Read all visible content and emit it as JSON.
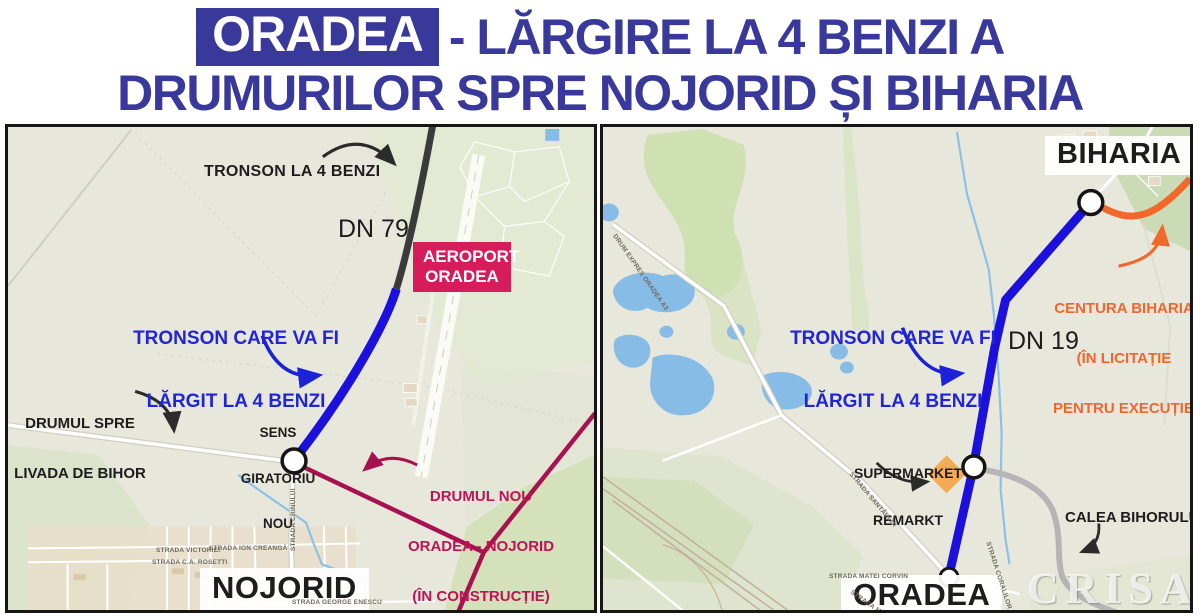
{
  "title": {
    "highlight": "ORADEA",
    "rest": "- LĂRGIRE LA 4 BENZI A",
    "line2": "DRUMURILOR SPRE NOJORID ȘI BIHARIA"
  },
  "colors": {
    "title_blue": "#39399B",
    "route_blue": "#1B10DC",
    "route_crimson": "#A8114F",
    "route_orange": "#F2682A",
    "route_gray": "#B5B5B5",
    "airport_badge_pink": "#D61C5B",
    "map_background": "#E8E7DC"
  },
  "left_map": {
    "annotations": {
      "four_lane": "TRONSON LA 4 BENZI",
      "dn79": "DN 79",
      "airport": [
        "AEROPORT",
        "ORADEA"
      ],
      "widen": [
        "TRONSON CARE VA FI",
        "LĂRGIT LA 4 BENZI"
      ],
      "livada": [
        "DRUMUL SPRE",
        "LIVADA DE BIHOR"
      ],
      "roundabout": [
        "SENS",
        "GIRATORIU",
        "NOU"
      ],
      "new_road": [
        "DRUMUL NOU",
        "ORADEA - NOJORID",
        "(ÎN CONSTRUCȚIE)"
      ],
      "town": "NOJORID"
    },
    "streets": {
      "victoriei": "STRADA VICTORIEI",
      "creanga": "STRADA ION CREANGĂ",
      "rosetti": "STRADA C.A. ROSETTI",
      "enescu": "STRADA GEORGE ENESCU",
      "crinului": "STRADA CRINULUI"
    }
  },
  "right_map": {
    "annotations": {
      "town_top": "BIHARIA",
      "widen": [
        "TRONSON CARE VA FI",
        "LĂRGIT LA 4 BENZI"
      ],
      "dn19": "DN 19",
      "centura": [
        "CENTURA BIHARIA",
        "(ÎN LICITAȚIE",
        "PENTRU EXECUȚIE)"
      ],
      "supermarket": [
        "SUPERMARKET",
        "REMARKT"
      ],
      "calea": "CALEA BIHORULUI",
      "town_bottom": "ORADEA",
      "watermark": "CRISANA"
    },
    "streets": {
      "expres": "DRUM EXPRES ORADEA A3",
      "matei": "STRADA MATEI CORVIN",
      "santaului": "STRADA SANTĂULUI",
      "coralilor": "STRADA CORALILOR"
    }
  }
}
